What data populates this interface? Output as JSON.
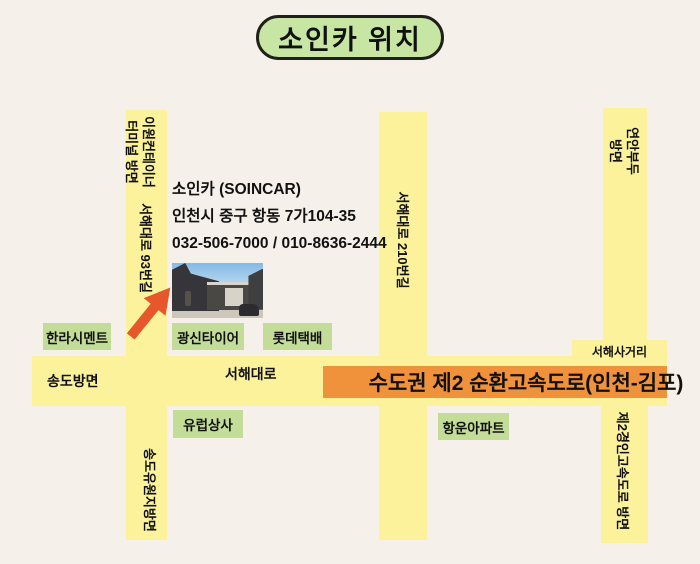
{
  "title": "소인카 위치",
  "business": {
    "name": "소인카 (SOINCAR)",
    "address": "인천시 중구 항동 7가104-35",
    "phones": "032-506-7000 / 010-8636-2444"
  },
  "roads": {
    "left_top": {
      "line1": "이원컨테이너",
      "line2": "터미널 방면"
    },
    "left_mid": "서해대로 93번길",
    "left_bottom": "송도유원지방면",
    "center": "서해대로 210번길",
    "right_top": {
      "line1": "연안부두",
      "line2": "방면"
    },
    "right_bottom": "제2경인고속도로 방면",
    "main_road": "서해대로",
    "main_road_west": "송도방면",
    "intersection": "서해사거리",
    "highway": "수도권 제2 순환고속도로(인천-김포)"
  },
  "landmarks": {
    "halla_cement": "한라시멘트",
    "gwangsin_tire": "광신타이어",
    "lotte_parcel": "롯데택배",
    "europe_trading": "유럽상사",
    "hangun_apartment": "항운아파트"
  },
  "colors": {
    "background": "#F5F1EA",
    "road_yellow": "#FBF29B",
    "label_green": "#C3DC97",
    "title_green": "#C7E6A3",
    "highway_orange": "#F0913C",
    "arrow_orange": "#E6582C"
  }
}
